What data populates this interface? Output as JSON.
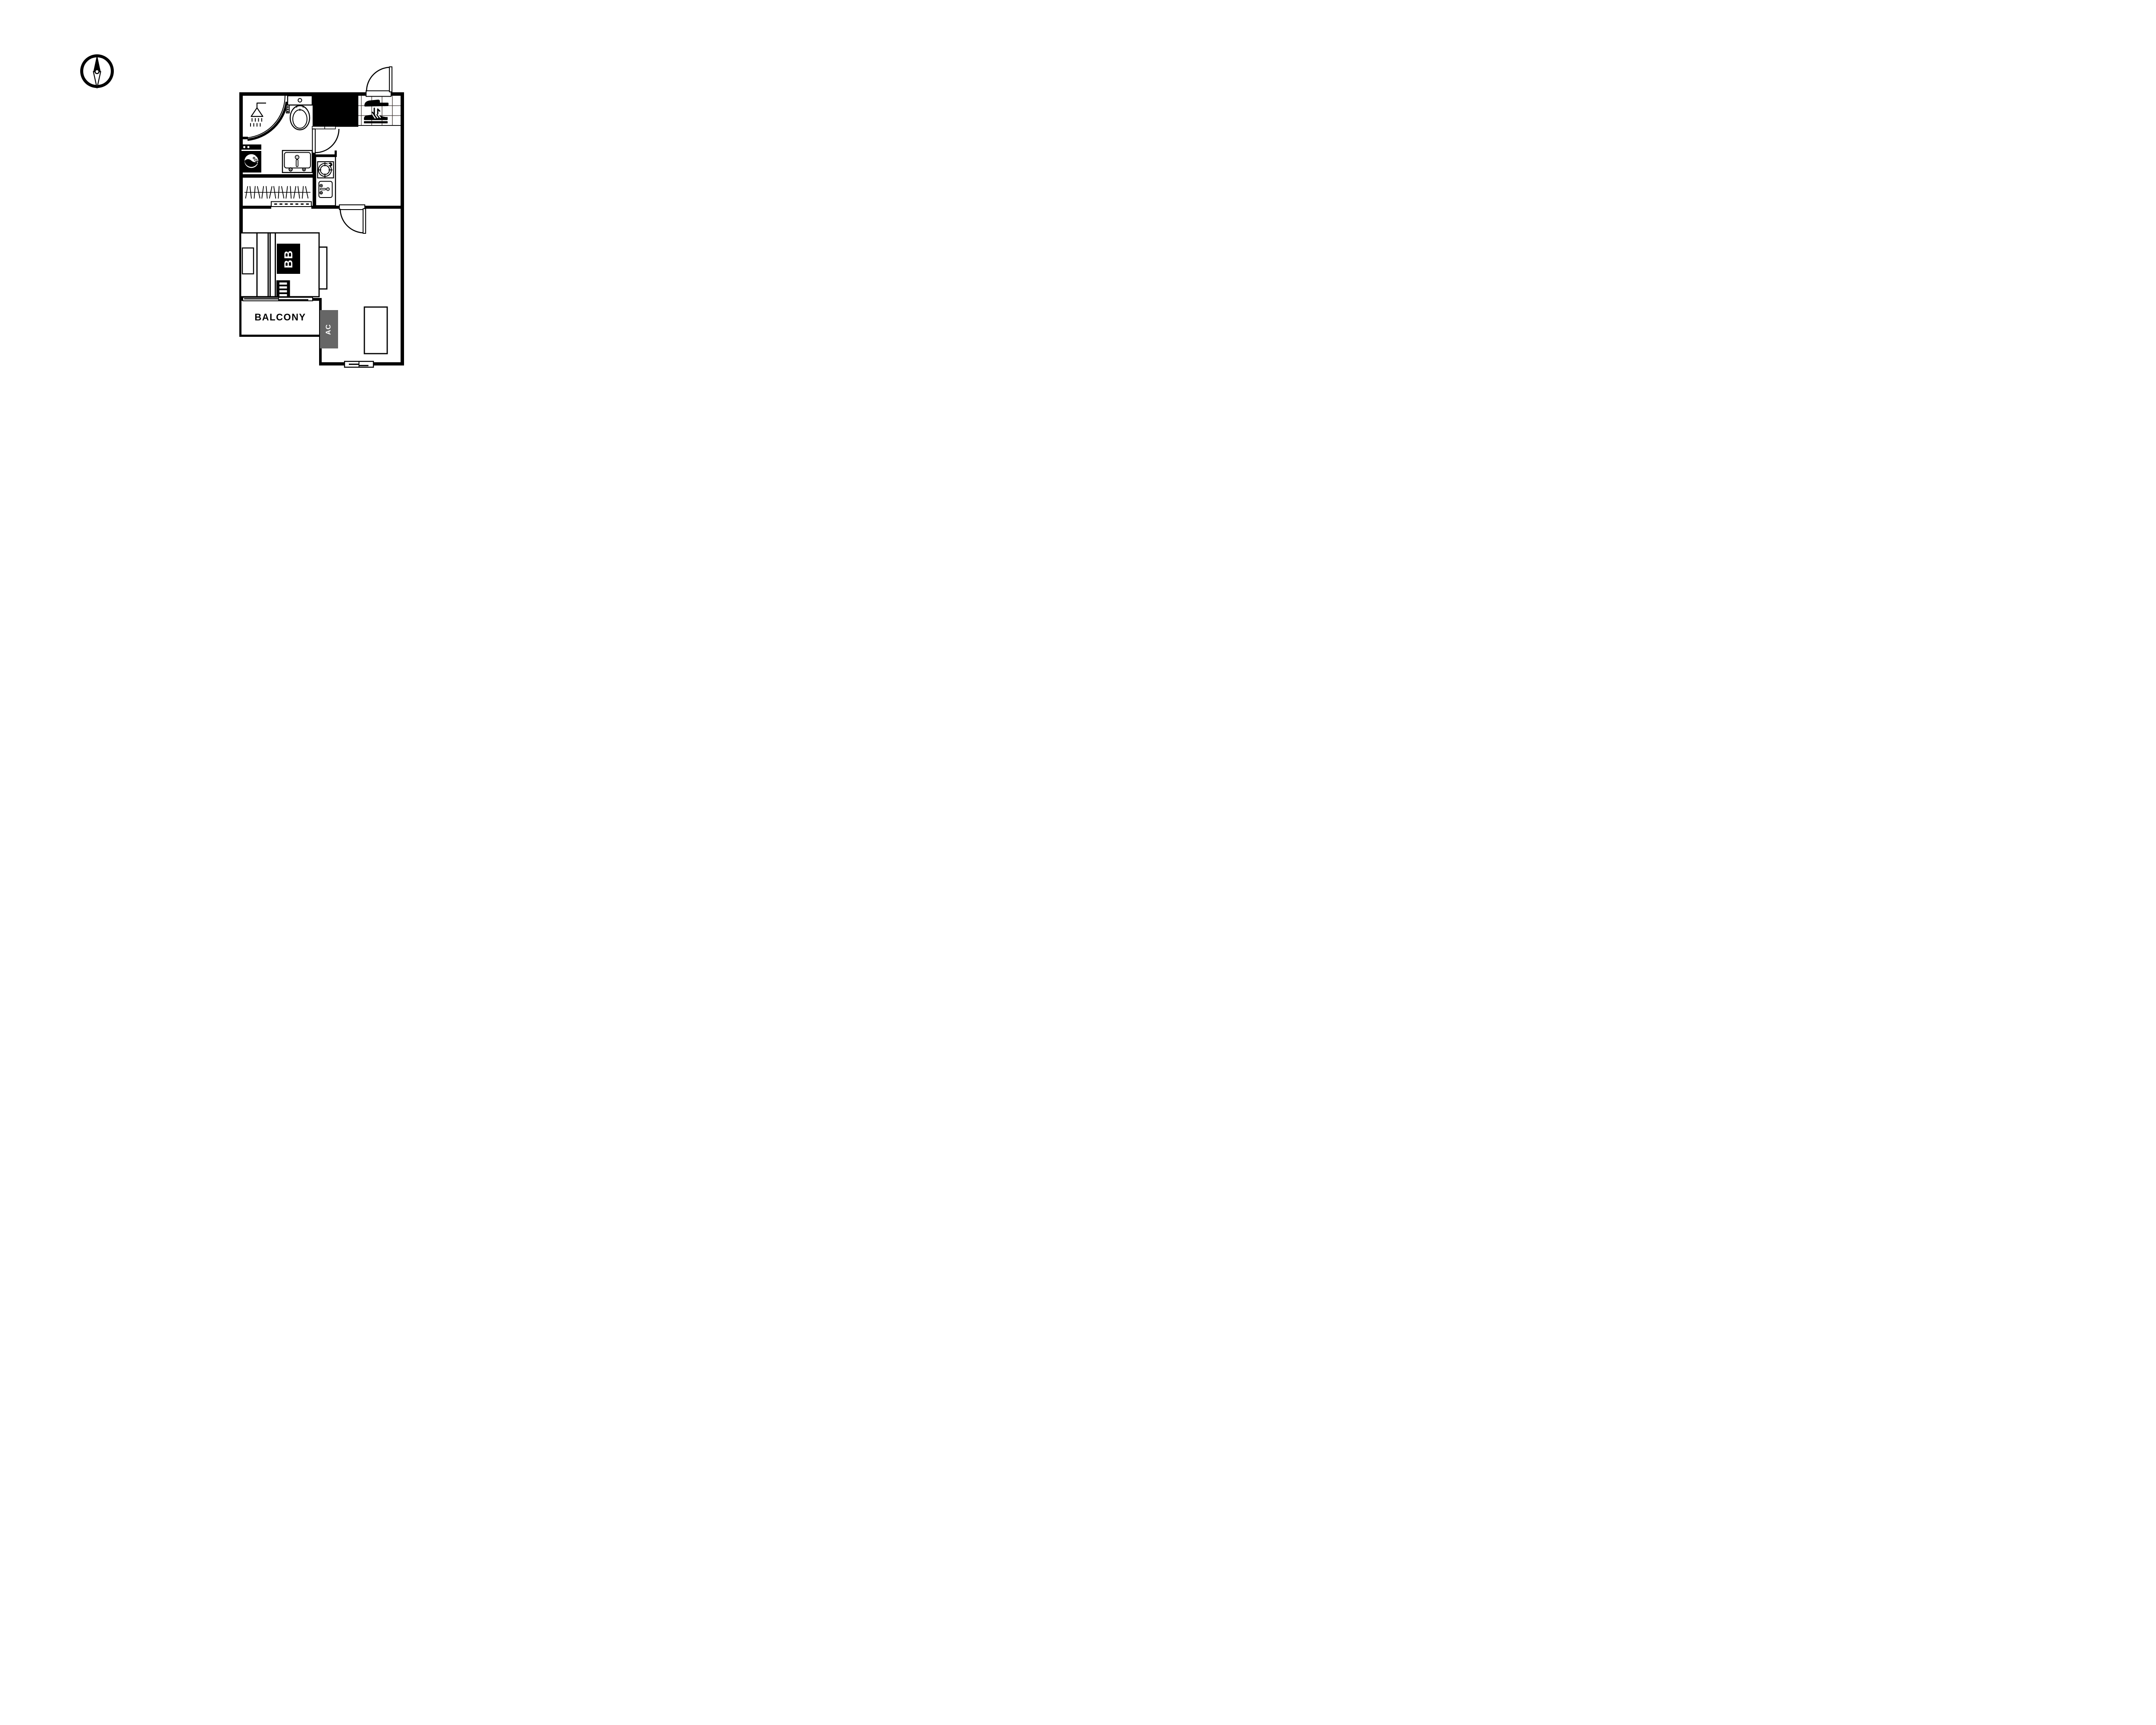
{
  "diagram": {
    "type": "apartment-floor-plan",
    "orientation_symbol": "compass-north-needle"
  },
  "labels": {
    "balcony": "BALCONY",
    "ac_unit": "AC",
    "bunk_bed": "BB"
  },
  "colors": {
    "wall": "#000000",
    "ac_badge": "#666666",
    "label_on_dark": "#ffffff",
    "tile_grid": "#3a3230",
    "background": "#ffffff"
  },
  "icons": [
    "compass-icon",
    "shower-icon",
    "toilet-icon",
    "washing-machine-icon",
    "sink-vanity-icon",
    "stove-burner-icon",
    "kitchen-sink-icon",
    "shoe-change-icon",
    "hanger-rail-icon",
    "door-swing-arc",
    "sliding-door-icon",
    "window-icon"
  ]
}
